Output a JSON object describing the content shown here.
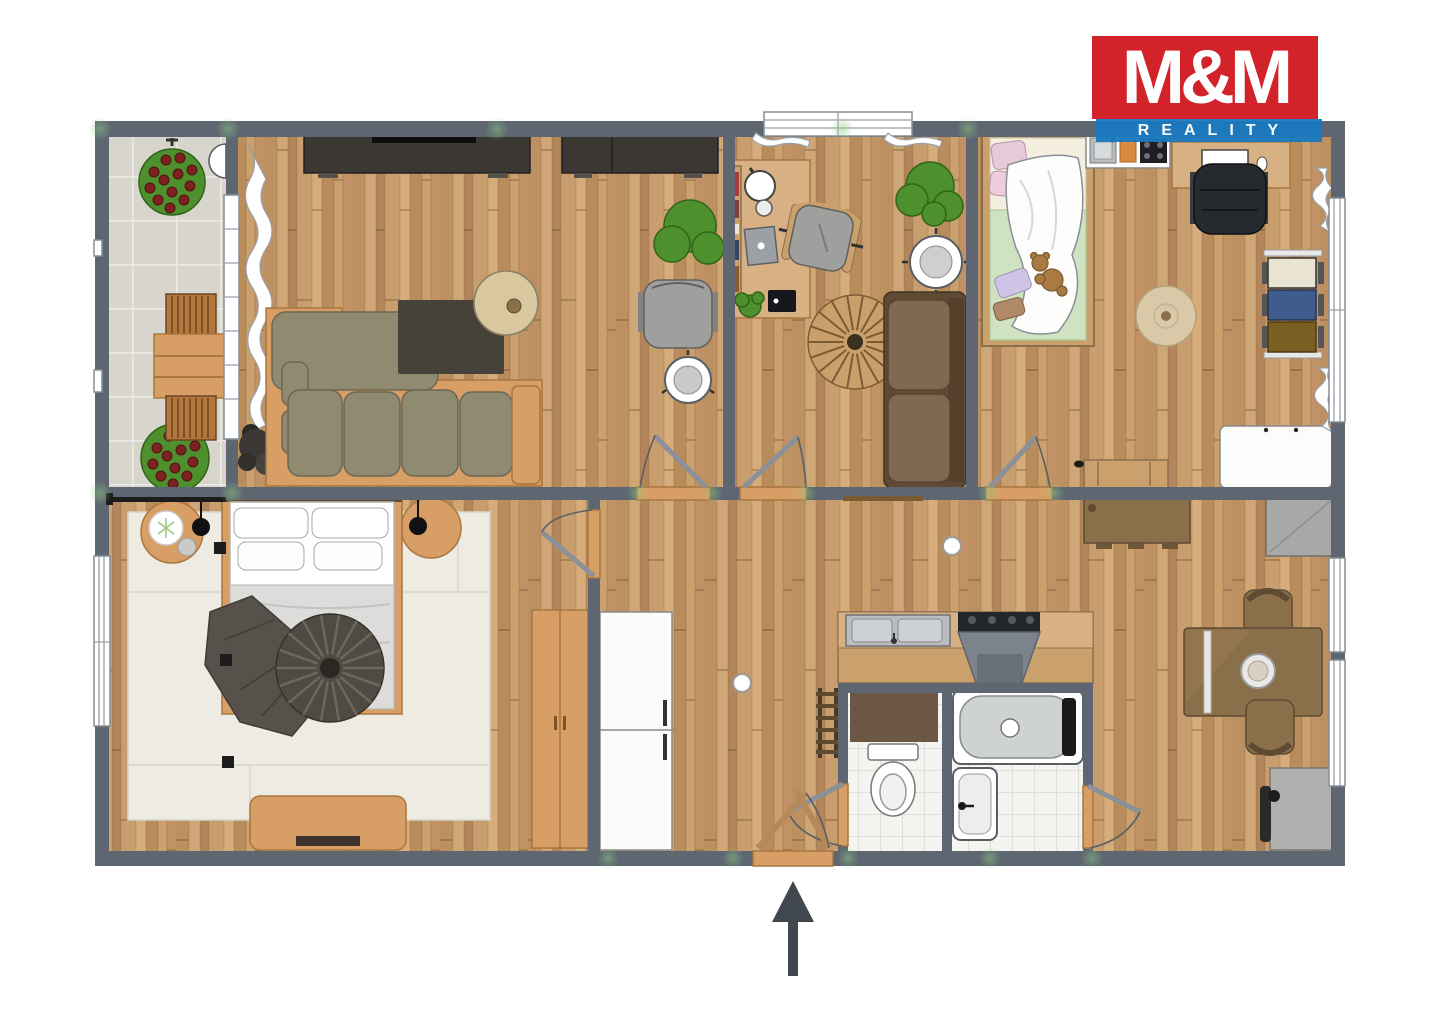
{
  "logo": {
    "title": "M&M",
    "subtitle": "REALITY"
  },
  "icons": {
    "north_arrow": "up-arrow",
    "wall_lamp": "half-disc-lamp",
    "ceiling_light": "round-light"
  },
  "colors": {
    "wall": "#5d6671",
    "wood_trim": "#d79e66",
    "furn_brown": "#8a6f4b",
    "sofa_olive": "#8f8a70",
    "sofa_brown": "#7d6548",
    "rug_dark": "#474239",
    "rug_ivory": "#edebe2",
    "terrace_tile": "#d8d5cd",
    "bath_tile": "#f4f4f1",
    "plant_green": "#4e8f2e",
    "berry_red": "#7d2121",
    "logo_red": "#d2232a",
    "logo_blue": "#1a7ac0",
    "arrow": "#40474e",
    "gray_cabinet": "#a8a8a6"
  }
}
